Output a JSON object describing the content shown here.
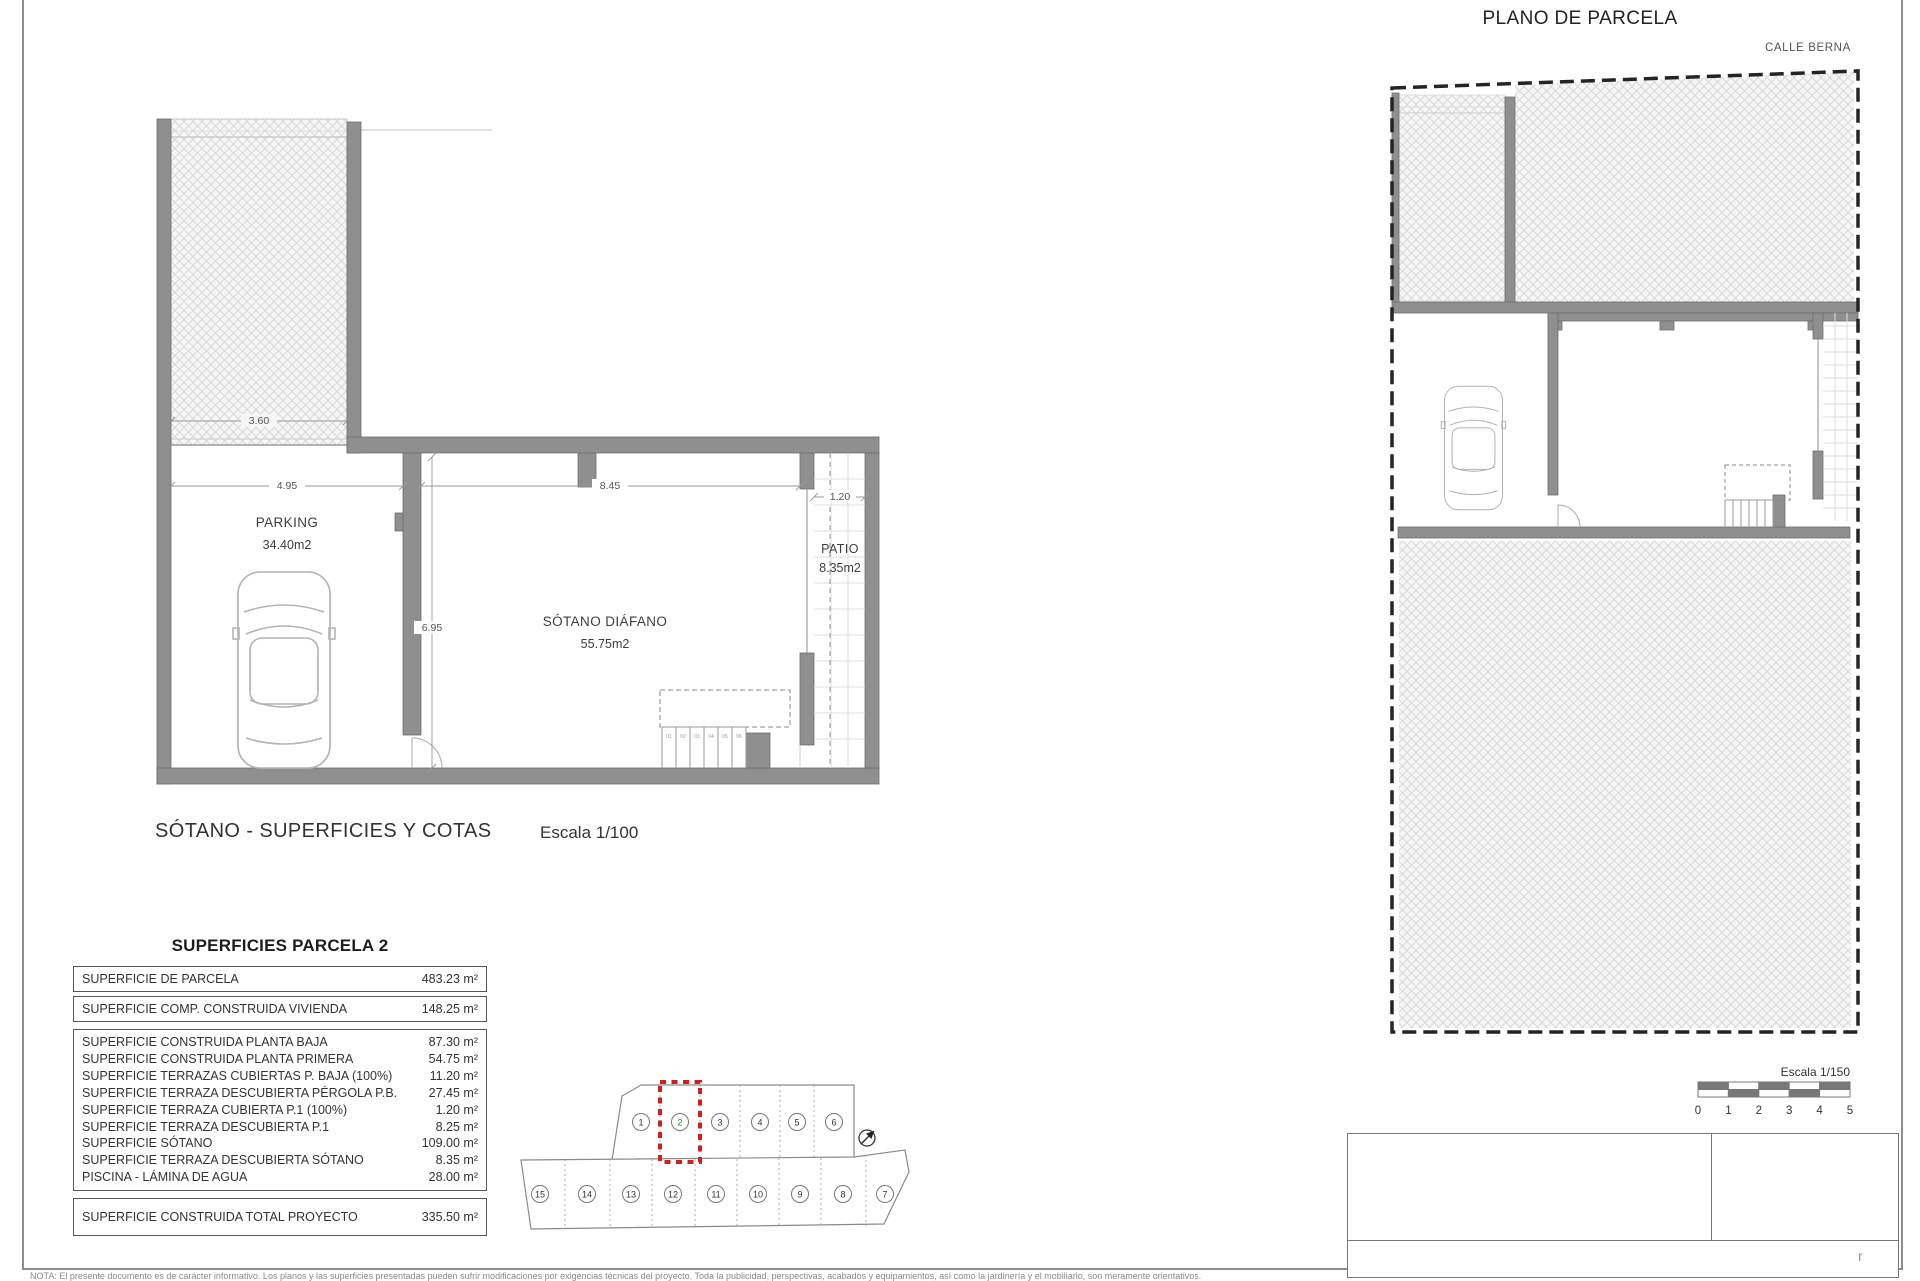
{
  "colors": {
    "wall": "#8f8f8f",
    "accent_red": "#cf1f1f",
    "highlight_green": "#1f8b3b",
    "boundary": "#242424"
  },
  "left_plan": {
    "caption": "SÓTANO - SUPERFICIES Y COTAS",
    "scale": "Escala 1/100",
    "parking_name": "PARKING",
    "parking_area": "34.40m2",
    "sotano_name": "SÓTANO DIÁFANO",
    "sotano_area": "55.75m2",
    "patio_name": "PATIO",
    "patio_area": "8.35m2",
    "dim_ramp": "3.60",
    "dim_parking": "4.95",
    "dim_sotano": "8.45",
    "dim_patio": "1.20",
    "dim_depth": "6.95",
    "steps": [
      "01",
      "02",
      "03",
      "04",
      "05",
      "06"
    ]
  },
  "areas_table": {
    "title": "SUPERFICIES PARCELA 2",
    "summary_rows": [
      {
        "label": "SUPERFICIE DE PARCELA",
        "value": "483.23 m²"
      },
      {
        "label": "SUPERFICIE COMP. CONSTRUIDA VIVIENDA",
        "value": "148.25 m²"
      }
    ],
    "detail_rows": [
      {
        "label": "SUPERFICIE CONSTRUIDA PLANTA BAJA",
        "value": "87.30 m²"
      },
      {
        "label": "SUPERFICIE CONSTRUIDA PLANTA PRIMERA",
        "value": "54.75 m²"
      },
      {
        "label": "SUPERFICIE TERRAZAS CUBIERTAS P. BAJA (100%)",
        "value": "11.20 m²"
      },
      {
        "label": "SUPERFICIE TERRAZA DESCUBIERTA PÉRGOLA P.B.",
        "value": "27.45 m²"
      },
      {
        "label": "SUPERFICIE TERRAZA CUBIERTA P.1 (100%)",
        "value": "1.20 m²"
      },
      {
        "label": "SUPERFICIE TERRAZA DESCUBIERTA P.1",
        "value": "8.25 m²"
      },
      {
        "label": "SUPERFICIE SÓTANO",
        "value": "109.00 m²"
      },
      {
        "label": "SUPERFICIE TERRAZA DESCUBIERTA SÓTANO",
        "value": "8.35 m²"
      },
      {
        "label": "PISCINA - LÁMINA DE AGUA",
        "value": "28.00 m²"
      }
    ],
    "total_rows": [
      {
        "label": "SUPERFICIE CONSTRUIDA TOTAL PROYECTO",
        "value": "335.50 m²"
      }
    ]
  },
  "site_plan": {
    "title": "PLANO DE PARCELA",
    "street": "CALLE BERNA",
    "scale_label": "Escala 1/150",
    "scale_ticks": [
      "0",
      "1",
      "2",
      "3",
      "4",
      "5"
    ]
  },
  "key_plan": {
    "top_row": [
      "1",
      "2",
      "3",
      "4",
      "5",
      "6"
    ],
    "bottom_row": [
      "15",
      "14",
      "13",
      "12",
      "11",
      "10",
      "9",
      "8",
      "7"
    ],
    "highlighted_plot": "2"
  },
  "page": {
    "note": "NOTA: El presente documento es de carácter informativo. Los planos y las superficies presentadas pueden sufrir modificaciones por exigencias técnicas del proyecto. Toda la publicidad, perspectivas, acabados y equipamientos, así como la jardinería y el mobiliario, son meramente orientativos.",
    "title_block_mark": "r"
  }
}
